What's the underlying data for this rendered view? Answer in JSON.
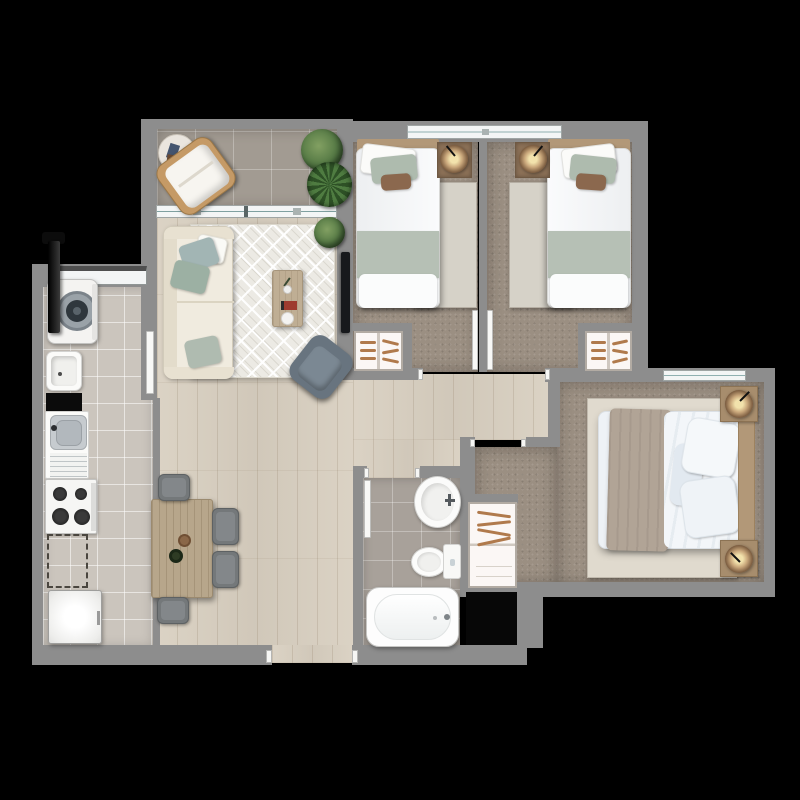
{
  "scene": {
    "type": "apartment floor plan, top-down 3D render",
    "background": "black",
    "no_text_labels": true
  },
  "palette": {
    "bg": "#000000",
    "wall": "#8d8d8d",
    "wood_floor": "#d9d0c1",
    "terrace_tile": "#a29b92",
    "kitchen_tile": "#cbc5bd",
    "bath_tile": "#a8a19a",
    "carpet": "#9b8f82",
    "rug_light": "#d6d2c8",
    "rug_master": "#e0dace",
    "rug_living": "#eceae4",
    "sofa_cream": "#f0ebdf",
    "sage_green": "#afbbb0",
    "duvet_white": "#eef2f6",
    "throw_taupe": "#b1a496",
    "headboard_wood": "#b29878",
    "table_wood": "#b7a68b",
    "chair_gray": "#74787a",
    "steel": "#c4c9cd",
    "plant_green": "#4e7340",
    "lamp_glow": "#f2e2ac",
    "hanger_brown": "#b07a4c",
    "window_white": "#f3f5f5",
    "tv_black": "#17191c",
    "shaft_black": "#070707"
  },
  "rooms": [
    {
      "name": "balcony terrace",
      "floor": "gray ceramic tile",
      "furniture": [
        "rattan lounge chair with white cushion",
        "round side table with books",
        "potted plant",
        "potted palm"
      ]
    },
    {
      "name": "living room",
      "floor": "light wood planks",
      "furniture": [
        "cream sofa with sage pillows",
        "diamond pattern area rug",
        "coffee table with tray, book and plant",
        "wall mounted tv",
        "gray swivel armchair",
        "corner plant"
      ]
    },
    {
      "name": "dining area",
      "floor": "light wood planks",
      "furniture": [
        "rectangular wood dining table",
        "four gray chairs",
        "wine bottle",
        "wooden bowl"
      ]
    },
    {
      "name": "kitchen and laundry",
      "floor": "light gray tile",
      "furniture": [
        "black riser pipe",
        "top-load washing machine",
        "laundry tub",
        "stainless sink with drainboard",
        "four-burner cooktop",
        "dashed future appliance space",
        "refrigerator"
      ]
    },
    {
      "name": "bedroom 1",
      "floor": "taupe carpet",
      "furniture": [
        "single bed with sage throw and brown cushion",
        "dome lamp on bedside mat",
        "light rug",
        "built-in wardrobe with hangers"
      ]
    },
    {
      "name": "bedroom 2",
      "floor": "taupe carpet",
      "furniture": [
        "single bed with sage throw and brown cushion (mirrored)",
        "dome lamp on bedside mat",
        "light rug",
        "built-in wardrobe with hangers"
      ]
    },
    {
      "name": "master bedroom",
      "floor": "taupe carpet",
      "furniture": [
        "double bed with taupe runner and wood headboard",
        "two wood nightstands with dome lamps",
        "cream rug",
        "built-in closet with hangers"
      ]
    },
    {
      "name": "bathroom",
      "floor": "beige tile",
      "furniture": [
        "oval pedestal sink",
        "toilet with tank",
        "bathtub"
      ]
    },
    {
      "name": "service shaft",
      "floor": "black void",
      "furniture": []
    }
  ],
  "openings": {
    "windows": [
      "terrace sliding glass door",
      "shared window over bedrooms 1 and 2",
      "master bedroom window",
      "laundry window"
    ],
    "doors": [
      "entrance opening at bottom",
      "laundry swing door",
      "bedroom 1 door",
      "bedroom 2 door",
      "master bedroom opening",
      "bathroom door"
    ]
  }
}
